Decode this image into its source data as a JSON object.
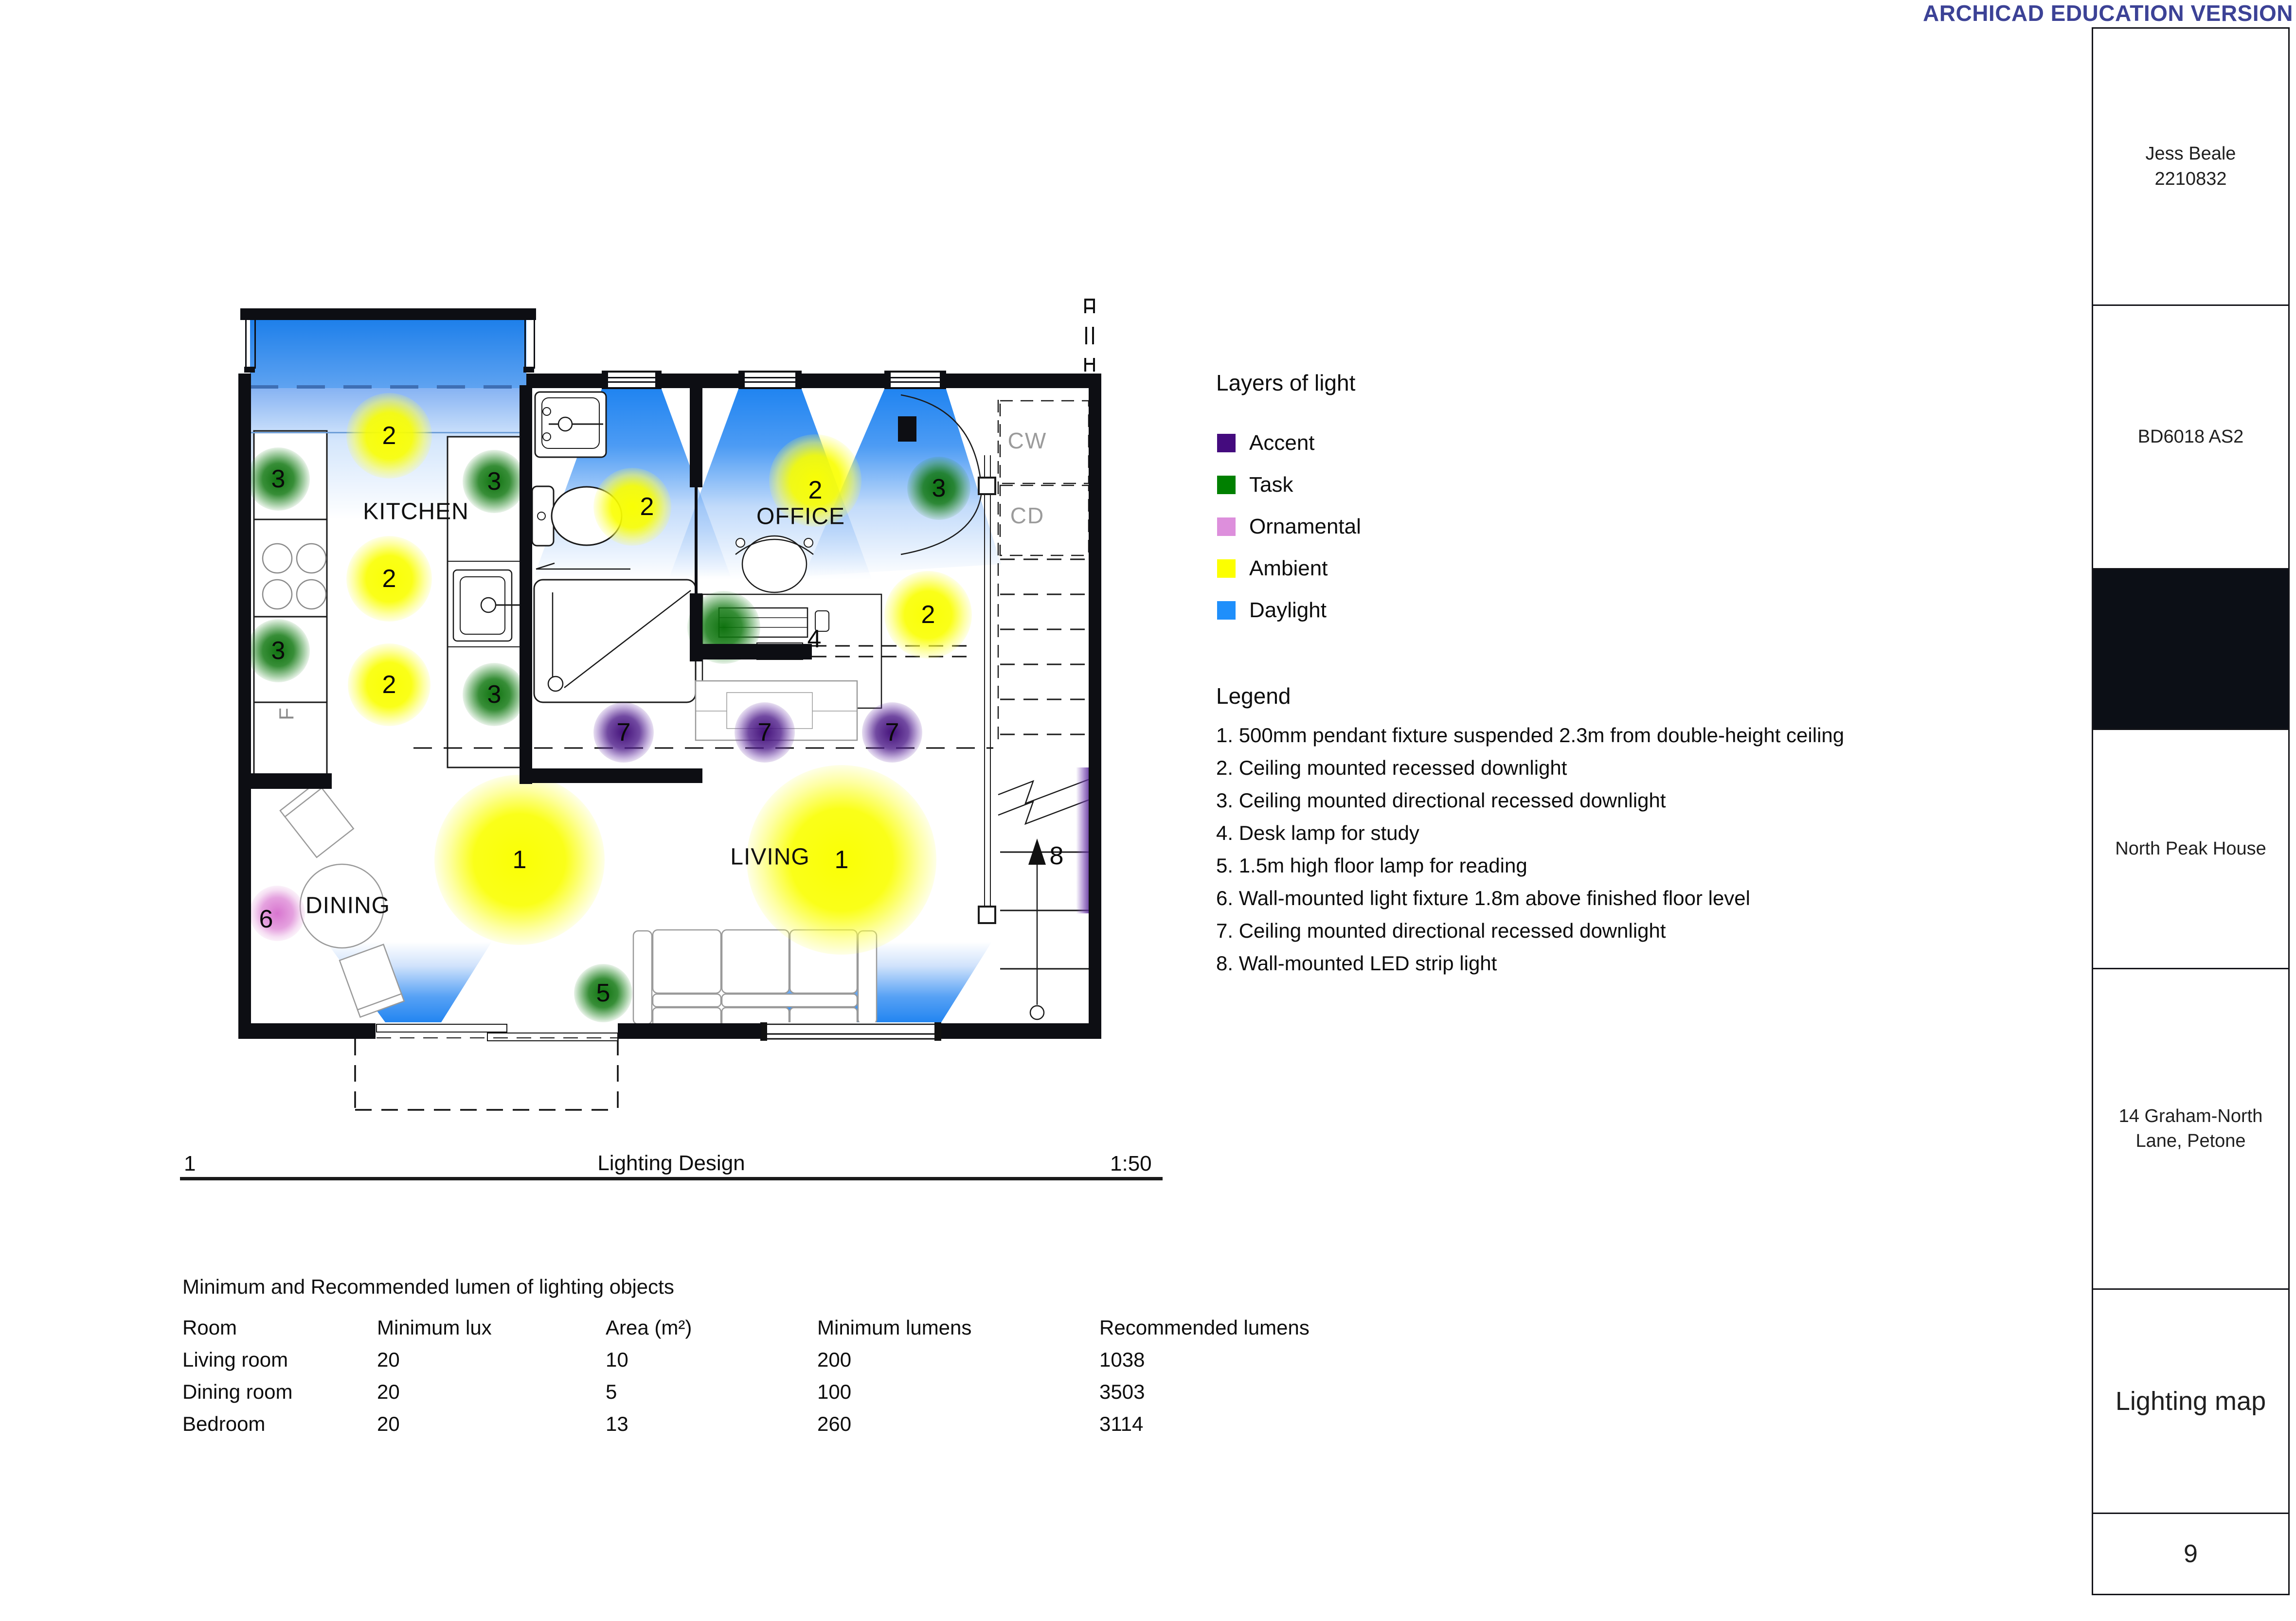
{
  "watermark": "ARCHICAD EDUCATION VERSION",
  "plan": {
    "rooms": {
      "kitchen": "KITCHEN",
      "office": "OFFICE",
      "dining": "DINING",
      "living": "LIVING"
    },
    "annotations": {
      "cw": "CW",
      "cd": "CD",
      "fridge": "F",
      "section_top": "A",
      "section_bottom": "H"
    },
    "markers": [
      {
        "n": "2"
      },
      {
        "n": "2"
      },
      {
        "n": "2"
      },
      {
        "n": "3"
      },
      {
        "n": "3"
      },
      {
        "n": "3"
      },
      {
        "n": "3"
      },
      {
        "n": "2"
      },
      {
        "n": "2"
      },
      {
        "n": "3"
      },
      {
        "n": "2"
      },
      {
        "n": "4"
      },
      {
        "n": "7"
      },
      {
        "n": "7"
      },
      {
        "n": "7"
      },
      {
        "n": "1"
      },
      {
        "n": "1"
      },
      {
        "n": "6"
      },
      {
        "n": "5"
      },
      {
        "n": "8"
      }
    ]
  },
  "layers_legend": {
    "title": "Layers of light",
    "items": [
      {
        "label": "Accent",
        "color": "#440b7e"
      },
      {
        "label": "Task",
        "color": "#008000"
      },
      {
        "label": "Ornamental",
        "color": "#dd8fdc"
      },
      {
        "label": "Ambient",
        "color": "#fcff00"
      },
      {
        "label": "Daylight",
        "color": "#1f8ffb"
      }
    ]
  },
  "legend": {
    "title": "Legend",
    "items": [
      "1. 500mm pendant fixture suspended 2.3m from double-height ceiling",
      "2. Ceiling mounted recessed downlight",
      "3. Ceiling mounted directional recessed downlight",
      "4. Desk lamp for study",
      "5. 1.5m high floor lamp for reading",
      "6. Wall-mounted light fixture 1.8m above finished floor level",
      "7. Ceiling mounted directional recessed downlight",
      "8. Wall-mounted LED strip light"
    ]
  },
  "drawing_title": {
    "number": "1",
    "name": "Lighting Design",
    "scale": "1:50"
  },
  "lumen_table": {
    "title": "Minimum and Recommended lumen of lighting objects",
    "columns": [
      "Room",
      "Minimum lux",
      "Area (m²)",
      "Minimum lumens",
      "Recommended lumens"
    ],
    "rows": [
      [
        "Living room",
        "20",
        "10",
        "200",
        "1038"
      ],
      [
        "Dining room",
        "20",
        "5",
        "100",
        "3503"
      ],
      [
        "Bedroom",
        "20",
        "13",
        "260",
        "3114"
      ]
    ]
  },
  "sidebar": {
    "student_name": "Jess Beale",
    "student_id": "2210832",
    "course": "BD6018 AS2",
    "project_name": "North Peak House",
    "address_line1": "14 Graham-North",
    "address_line2": "Lane, Petone",
    "sheet_title": "Lighting map",
    "page_number": "9"
  }
}
